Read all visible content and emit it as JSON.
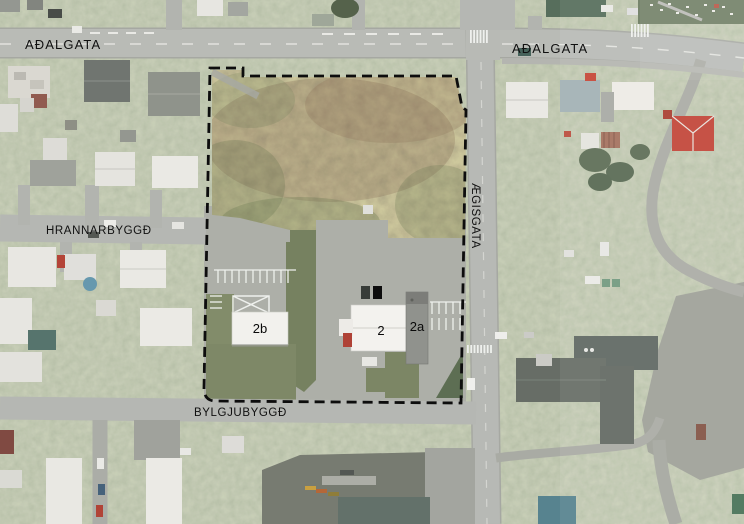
{
  "map": {
    "description": "Aerial orthophoto site plan with parcel boundary",
    "street_labels": {
      "adalgata_left": "AÐALGATA",
      "adalgata_right": "AÐALGATA",
      "aegisgata": "ÆGISGATA",
      "hrannarbyggd": "HRANNARBYGGÐ",
      "bylgjubyggd": "BYLGJUBYGGÐ"
    },
    "parcel_labels": {
      "building_2b": "2b",
      "building_2": "2",
      "building_2a": "2a"
    },
    "boundary": {
      "type": "parcel-boundary",
      "stroke_style": "dashed",
      "color": "#0d0d0d"
    },
    "palette": {
      "road": "#b6b8b3",
      "pavement": "#a9aba4",
      "lawn": "#848e70",
      "scrub_brown": "#6f6449",
      "building_white": "#f0efeb",
      "building_dark": "#5f665e",
      "roof_red": "#bf3c2e",
      "roof_blue": "#4e7d89",
      "label_color": "#101010"
    }
  }
}
